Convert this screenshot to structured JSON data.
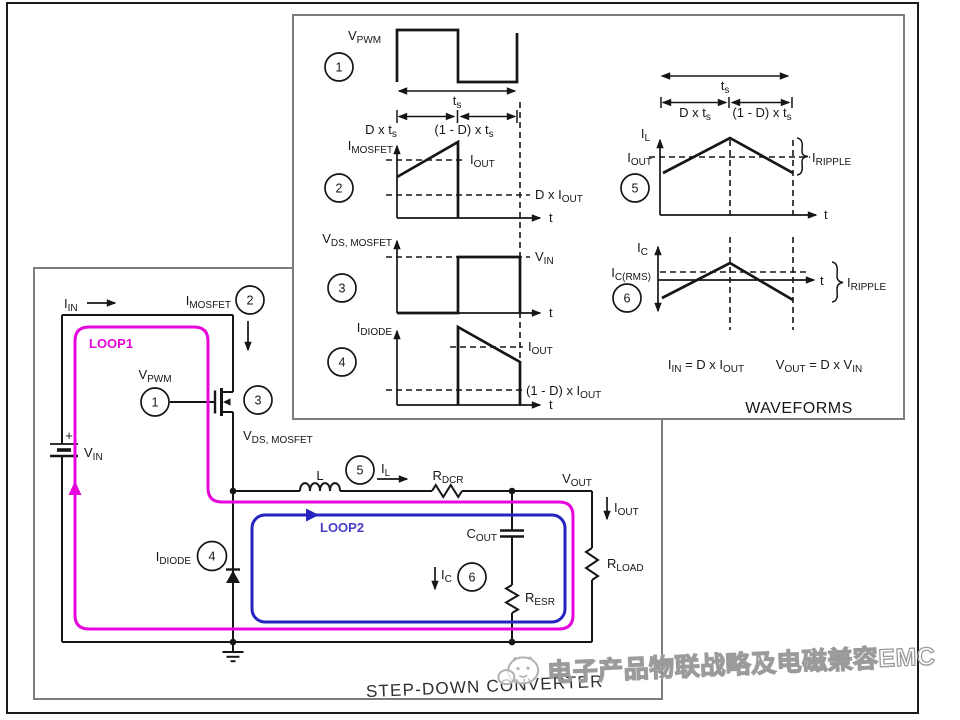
{
  "colors": {
    "background": "#ffffff",
    "ink": "#161616",
    "panel_border": "#7d7d7d",
    "loop1_magenta": "#e606dc",
    "loop2_blue": "#2524c0",
    "loop2_text": "#4a3fc9",
    "watermark_gray": "#9b9b9b"
  },
  "markers": {
    "n1": "1",
    "n2": "2",
    "n3": "3",
    "n4": "4",
    "n5": "5",
    "n6": "6"
  },
  "labels": {
    "vpwm": {
      "m": "V",
      "s": "PWM"
    },
    "ts": {
      "m": "t",
      "s": "s"
    },
    "dxts": {
      "m": "D x t",
      "s": "s"
    },
    "omdxts": {
      "m": "(1 - D) x t",
      "s": "s"
    },
    "imosfet": {
      "m": "I",
      "s": "MOSFET"
    },
    "iin": {
      "m": "I",
      "s": "IN"
    },
    "iout": {
      "m": "I",
      "s": "OUT"
    },
    "dxiout": {
      "m": "D x I",
      "s": "OUT"
    },
    "omdxiout": {
      "m": "(1 - D) x I",
      "s": "OUT"
    },
    "vds": {
      "m": "V",
      "s": "DS, MOSFET"
    },
    "vin": {
      "m": "V",
      "s": "IN"
    },
    "idiode": {
      "m": "I",
      "s": "DIODE"
    },
    "il": {
      "m": "I",
      "s": "L"
    },
    "iripple": {
      "m": "I",
      "s": "RIPPLE"
    },
    "ic": {
      "m": "I",
      "s": "C"
    },
    "icrms": {
      "m": "I",
      "s": "C(RMS)"
    },
    "t": "t",
    "plus": "+",
    "ind": "L",
    "rdcr": {
      "m": "R",
      "s": "DCR"
    },
    "vout": {
      "m": "V",
      "s": "OUT"
    },
    "cout": {
      "m": "C",
      "s": "OUT"
    },
    "resr": {
      "m": "R",
      "s": "ESR"
    },
    "rload": {
      "m": "R",
      "s": "LOAD"
    }
  },
  "equations": {
    "eq1": {
      "a": "I",
      "b": "IN",
      "c": " = D x I",
      "d": "OUT"
    },
    "eq2": {
      "a": "V",
      "b": "OUT",
      "c": " = D x V",
      "d": "IN"
    }
  },
  "waveform_panel": {
    "title": "WAVEFORMS"
  },
  "circuit_panel": {
    "title": "STEP-DOWN CONVERTER",
    "loop1": "LOOP1",
    "loop2": "LOOP2"
  },
  "watermark": {
    "text": "电子产品物联战略及电磁兼容EMC"
  }
}
